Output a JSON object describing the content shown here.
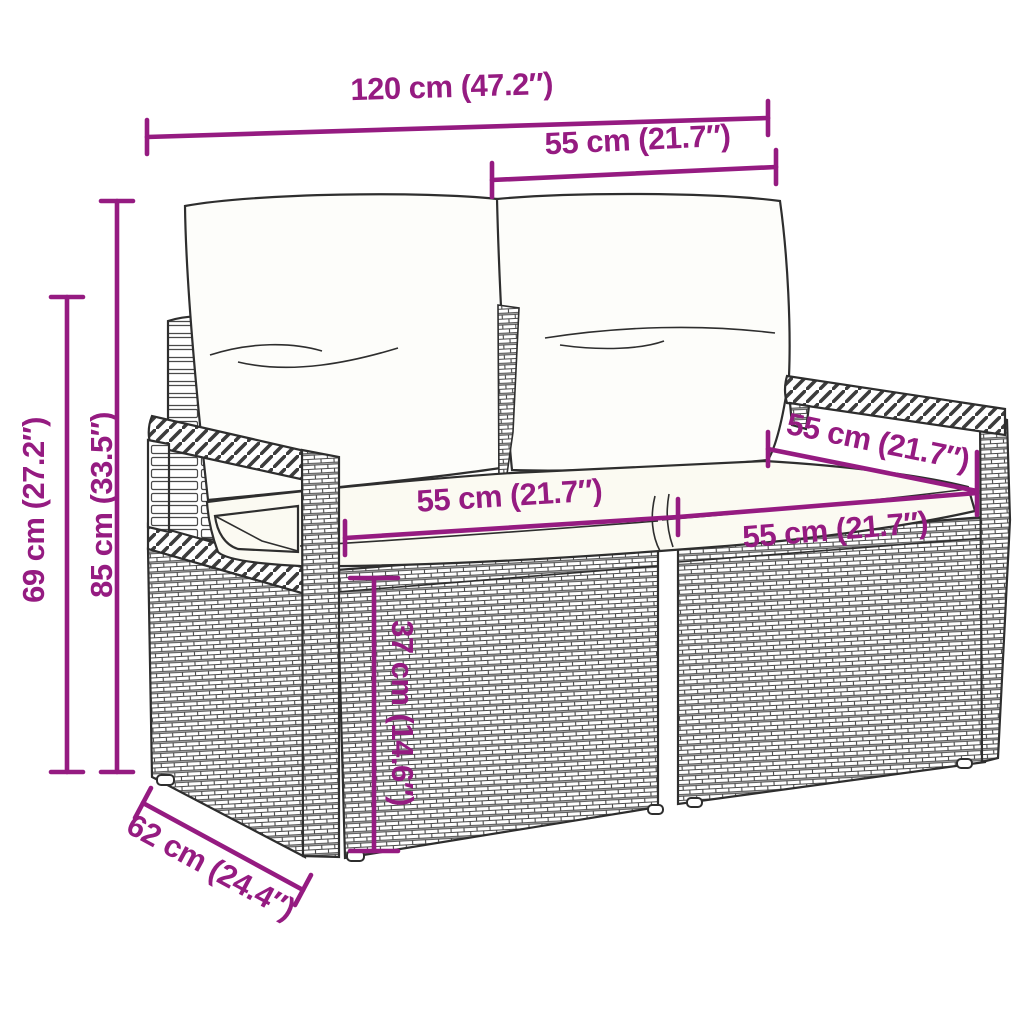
{
  "diagram": {
    "subject": "rattan-garden-loveseat-with-cushions",
    "accent_color": "#951b81",
    "outline_color": "#2e2e2e",
    "labels": {
      "overall_width": "120 cm (47.2″)",
      "backrest_section_width": "55 cm (21.7″)",
      "overall_height": "85 cm (33.5″)",
      "armrest_height": "69 cm (27.2″)",
      "seat_section_width_left": "55 cm (21.7″)",
      "seat_depth_diagonal": "55 cm (21.7″)",
      "seat_section_width_right": "55 cm (21.7″)",
      "seat_height": "37 cm (14.6″)",
      "overall_depth": "62 cm (24.4″)"
    }
  }
}
